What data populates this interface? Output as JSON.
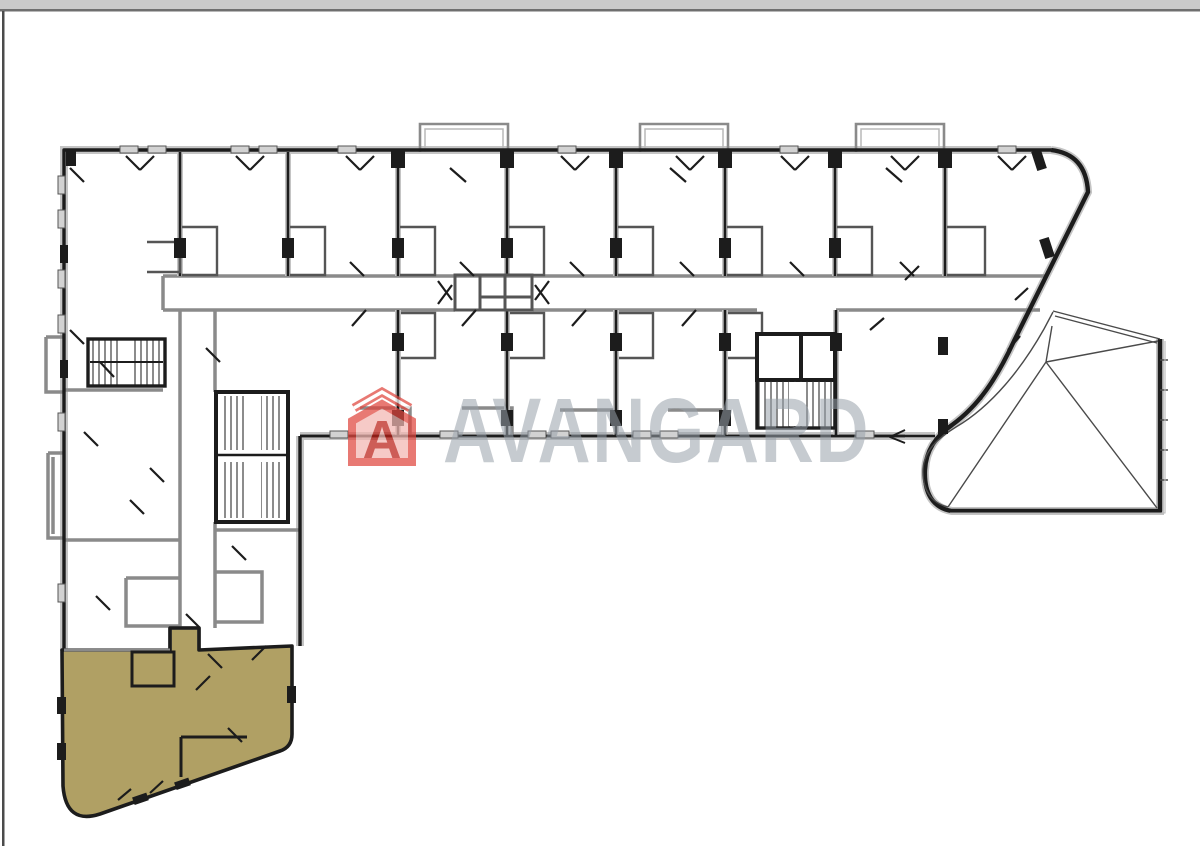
{
  "frame": {
    "top_bar_color": "#cacaca",
    "top_bar_border_color": "#6f6f6f",
    "left_line_color": "#4b4b4b"
  },
  "watermark": {
    "text": "AVANGARD",
    "logo_letter": "A",
    "text_color": "#97a0a9",
    "logo_color": "#e0463e",
    "logo_body_fill": "#f3b7b2",
    "logo_letter_color": "#bb1f17"
  },
  "plan": {
    "highlight_color": "#b0a064",
    "wall_color": "#1c1c1c",
    "casing_color": "#c4c4c4",
    "secondary_wall_color": "#8a8a8a",
    "light_wall_color": "#b8b8b8",
    "detail_color": "#555555",
    "roof_line_color": "#4a4a4a",
    "window_fill": "#d2d2d2"
  }
}
